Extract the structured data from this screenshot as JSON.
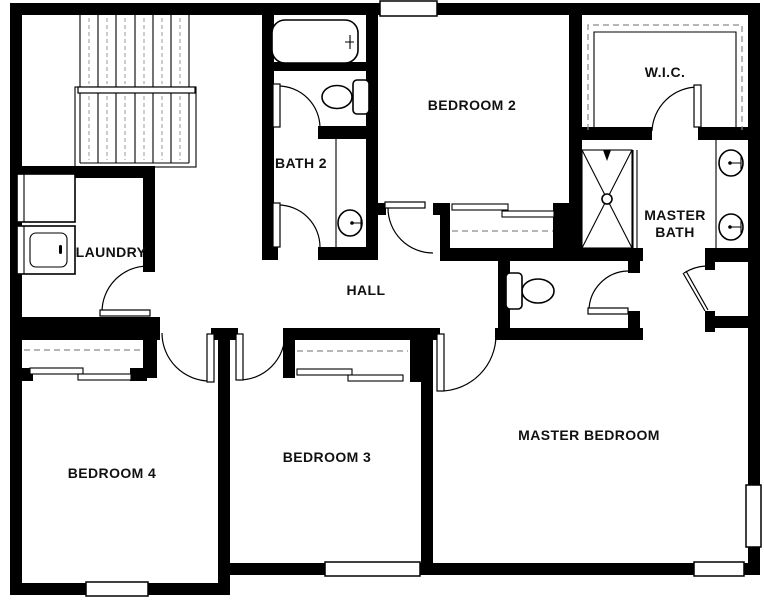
{
  "plan": {
    "type": "floor-plan",
    "colors": {
      "wall": "#000000",
      "background": "#ffffff",
      "label": "#111111",
      "dashed_lines": "#8a8a8a"
    },
    "rooms": {
      "laundry": {
        "label": "LAUNDRY"
      },
      "bath2": {
        "label": "BATH 2"
      },
      "bedroom2": {
        "label": "BEDROOM 2"
      },
      "wic": {
        "label": "W.I.C."
      },
      "master_bath": {
        "label_line1": "MASTER",
        "label_line2": "BATH"
      },
      "hall": {
        "label": "HALL"
      },
      "bedroom4": {
        "label": "BEDROOM 4"
      },
      "bedroom3": {
        "label": "BEDROOM 3"
      },
      "master_bedroom": {
        "label": "MASTER BEDROOM"
      }
    },
    "fixtures": [
      "stairs",
      "washer-icon",
      "dryer-icon",
      "bathtub-icon",
      "toilet-icon-bath2",
      "sink-icon-bath2",
      "toilet-icon-wc",
      "shower-icon",
      "double-sink-icons-master-bath",
      "closet-shelf-dashed-lines",
      "sliding-closet-doors",
      "door-swing-arcs",
      "windows"
    ]
  }
}
